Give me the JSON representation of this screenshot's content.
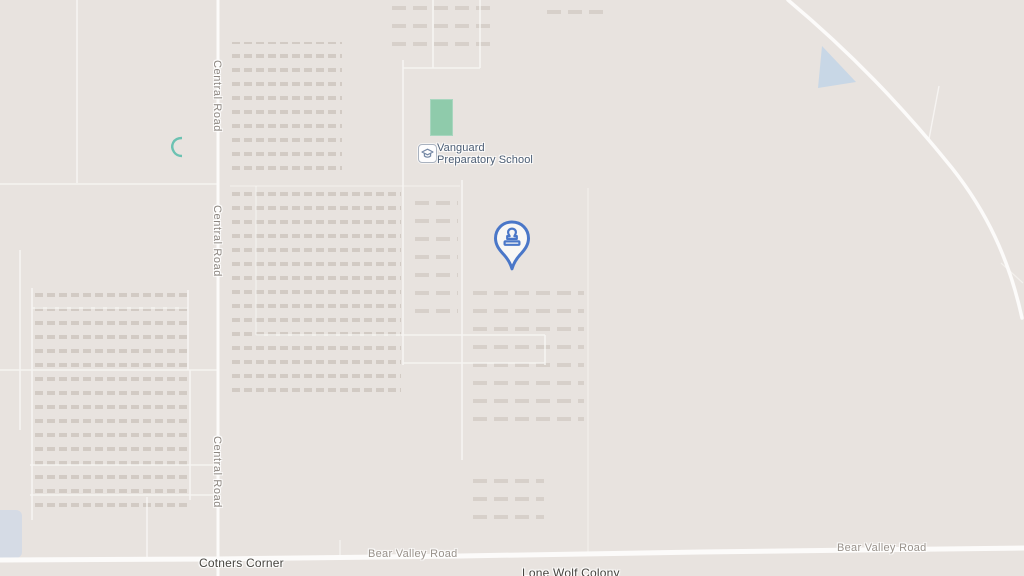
{
  "map": {
    "colors": {
      "background": "#e8e3df",
      "road": "#fcfbfa",
      "building": "#d9d3cd",
      "water": "#b9d2e8",
      "field_green": "#8fcbab",
      "marker_blue": "#4a77c8",
      "road_label_gray": "#98918a",
      "place_label_dark": "#474540",
      "school_label_blue": "#4b5d74"
    },
    "labels": {
      "central_road": "Central Road",
      "bear_valley_road": "Bear Valley Road",
      "cotners_corner": "Cotners Corner",
      "lone_wolf_colony": "Lone Wolf Colony"
    },
    "poi": {
      "school": {
        "name": "Vanguard Preparatory School",
        "line1": "Vanguard",
        "line2": "Preparatory School"
      }
    }
  }
}
